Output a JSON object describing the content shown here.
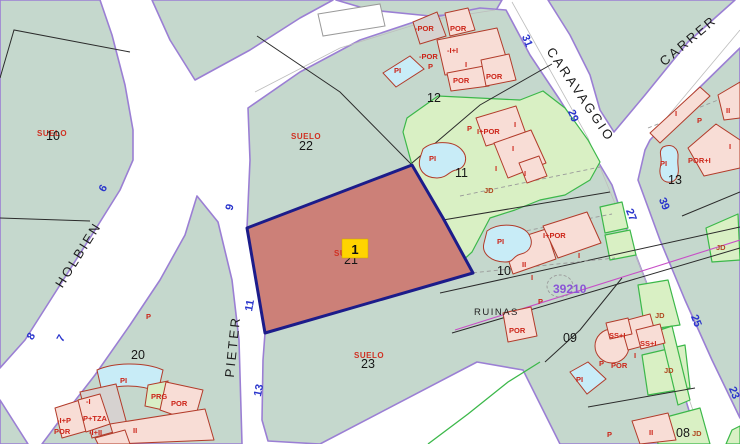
{
  "colors": {
    "parcel_teal": "#c5d8cd",
    "road_white": "#ffffff",
    "road_edge_purple": "#9b7fd4",
    "highlight_fill": "#cc8078",
    "highlight_border": "#1c1c8a",
    "selection_yellow": "#ffd400",
    "building_pink": "#f8ddd6",
    "building_border": "#b23b2a",
    "pool_cyan": "#c8ecf7",
    "garden_green": "#d9f0c4",
    "garden_border": "#3cb84a",
    "street_number_blue": "#2a35cc",
    "label_red": "#cc2418",
    "zone_purple": "#8a55d6",
    "zone_line_magenta": "#c74ec7"
  },
  "streets": {
    "holbien": "HOLBIEN",
    "pieter": "PIETER",
    "caravaggio": "CARAVAGGIO",
    "carrer": "CARRER"
  },
  "street_numbers": {
    "n6": "6",
    "n7": "7",
    "n8": "8",
    "n9": "9",
    "n11": "11",
    "n13": "13",
    "n23": "23",
    "n25": "25",
    "n27": "27",
    "n29": "29",
    "n31": "31",
    "n39": "39"
  },
  "parcel_numbers": {
    "p10_nw": "10",
    "p20": "20",
    "p22": "22",
    "p12": "12",
    "p11": "11",
    "p21": "21",
    "p23": "23",
    "p10_e": "10",
    "p09": "09",
    "p08": "08",
    "p13_e": "13"
  },
  "land_labels": {
    "suelo_10": "SUELO",
    "suelo_22": "SUELO",
    "suelo_21": "SUELO",
    "suelo_23": "SUELO",
    "ruinas": "RUINAS",
    "zone_number": "39210"
  },
  "selection": {
    "parcel_badge": "1"
  },
  "building_labels": {
    "b12_mpor1": "-POR",
    "b12_por1": "POR",
    "b12_mii": "-I+I",
    "b12_mpor2": "-POR",
    "b12_p": "P",
    "b12_i": "I",
    "b12_por2": "POR",
    "b12_por3": "POR",
    "b12_pi": "PI",
    "b11_p": "P",
    "b11_ipor": "I+POR",
    "b11_pi": "PI",
    "b11_i1": "I",
    "b11_i2": "I",
    "b11_i3": "I",
    "b11_i4": "I",
    "b11_jd": "JD",
    "b10_pi": "PI",
    "b10_ipor": "I+POR",
    "b10_ii": "II",
    "b10_i1": "I",
    "b10_i2": "I",
    "b10_p": "P",
    "b10_por": "POR",
    "b9_ss1": "SS+I",
    "b9_ss2": "SS+I",
    "b9_i": "I",
    "b9_p": "P",
    "b9_por": "POR",
    "b9_jd1": "JD",
    "b9_jd2": "JD",
    "b9_jd3": "JD",
    "b9_jd4": "JD",
    "b9_pi": "PI",
    "b9_p2": "P",
    "b8_ii": "II",
    "b13_i1": "I",
    "b13_p": "P",
    "b13_ii": "II",
    "b13_i2": "I",
    "b13_pori": "POR+I",
    "b13_pi": "PI",
    "b20_pi": "PI",
    "b20_mi": "-I",
    "b20_prg": "PRG",
    "b20_por": "POR",
    "b20_ii": "II",
    "b20_c1": "-I+P",
    "b20_c2": "P+TZA",
    "b20_c3": "POR",
    "b20_c4": "-I+II",
    "b20_p": "P"
  }
}
